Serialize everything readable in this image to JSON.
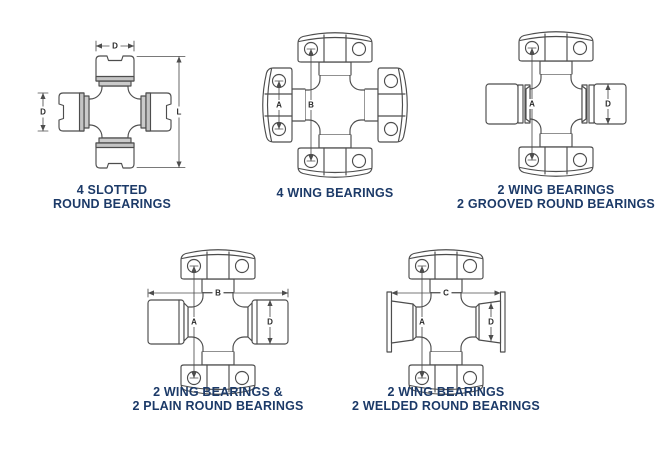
{
  "background": "#ffffff",
  "colors": {
    "line": "#4d4d4d",
    "caption_text": "#1c3a68",
    "dimension_label": "#2b2b2b",
    "shading": "#c8c8c8"
  },
  "diagrams": [
    {
      "name": "4-slotted-round-bearings",
      "caption": [
        "4 SLOTTED",
        "ROUND BEARINGS"
      ],
      "dims": {
        "d_top": "D",
        "d_left": "D",
        "l_right": "L"
      }
    },
    {
      "name": "4-wing-bearings",
      "caption": [
        "4 WING BEARINGS"
      ],
      "dims": {
        "a": "A",
        "b": "B"
      }
    },
    {
      "name": "2-wing-2-grooved-round-bearings",
      "caption": [
        "2 WING BEARINGS",
        "2 GROOVED ROUND BEARINGS"
      ],
      "dims": {
        "a": "A",
        "d": "D"
      }
    },
    {
      "name": "2-wing-2-plain-round-bearings",
      "caption": [
        "2 WING BEARINGS &",
        "2 PLAIN ROUND BEARINGS"
      ],
      "dims": {
        "b": "B",
        "a": "A",
        "d": "D"
      }
    },
    {
      "name": "2-wing-2-welded-round-bearings",
      "caption": [
        "2 WING BEARINGS",
        "2 WELDED ROUND BEARINGS"
      ],
      "dims": {
        "c": "C",
        "a": "A",
        "d": "D"
      }
    }
  ]
}
